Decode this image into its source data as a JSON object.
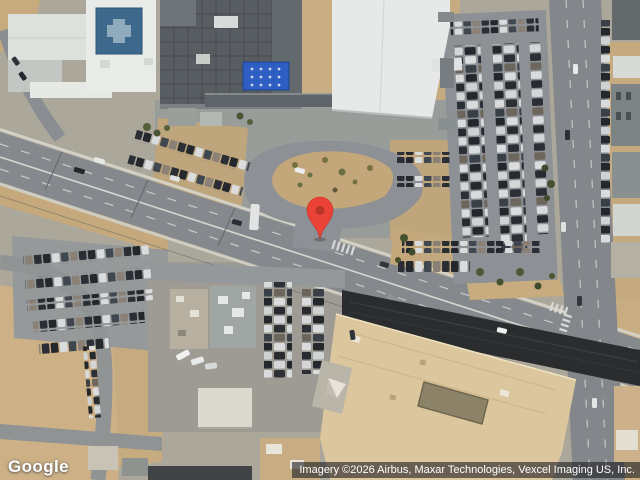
{
  "map": {
    "view": "satellite",
    "logo_text": "Google",
    "attribution_text": "Imagery ©2026 Airbus, Maxar Technologies, Vexcel Imaging US, Inc.",
    "marker": {
      "color": "#EA4335",
      "dot_color": "#BA3327",
      "edge_color": "#C5221F"
    }
  },
  "palette": {
    "sand": "#cbae83",
    "road": "#85898d",
    "road_dark_band": "#2a2c2e",
    "roof_white": "#e8eae7",
    "roof_dark": "#585d61",
    "helipad_blue": "#3e688c",
    "rooftop_panel_blue": "#2e5ec4",
    "building_beige": "#dcc69d"
  }
}
